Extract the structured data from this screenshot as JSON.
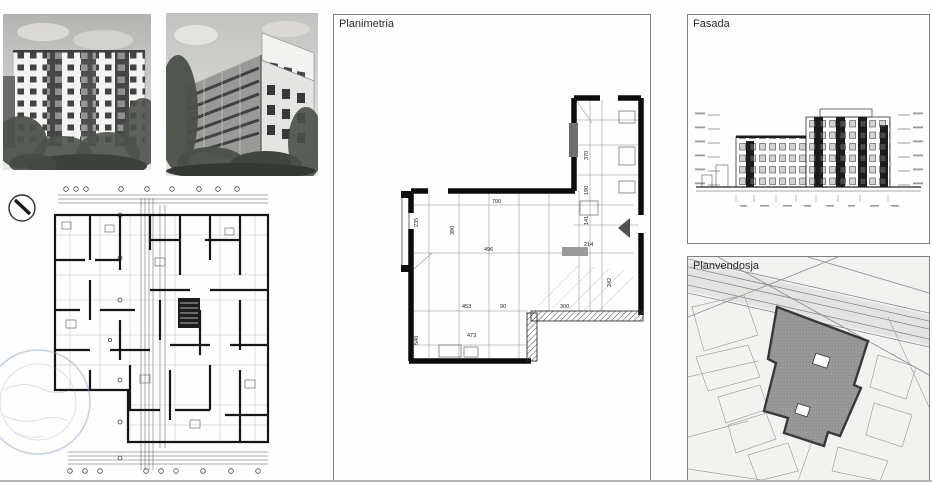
{
  "sheet": {
    "colors": {
      "ink": "#1a1a1a",
      "panel_border": "#7f7f7f",
      "stamp_blue": "#7b97c9",
      "footprint_gray": "#949494"
    }
  },
  "panels": {
    "planimetria": {
      "label": "Planimetria"
    },
    "fasada": {
      "label": "Fasada"
    },
    "planvendosja": {
      "label": "Planvendosja"
    }
  },
  "apartment_plan": {
    "dims": [
      {
        "text": "700"
      },
      {
        "text": "496"
      },
      {
        "text": "453"
      },
      {
        "text": "473"
      },
      {
        "text": "90"
      },
      {
        "text": "300"
      },
      {
        "text": "214"
      },
      {
        "text": "540"
      },
      {
        "text": "235"
      },
      {
        "text": "390"
      },
      {
        "text": "370"
      },
      {
        "text": "190"
      },
      {
        "text": "141"
      },
      {
        "text": "242"
      }
    ]
  }
}
